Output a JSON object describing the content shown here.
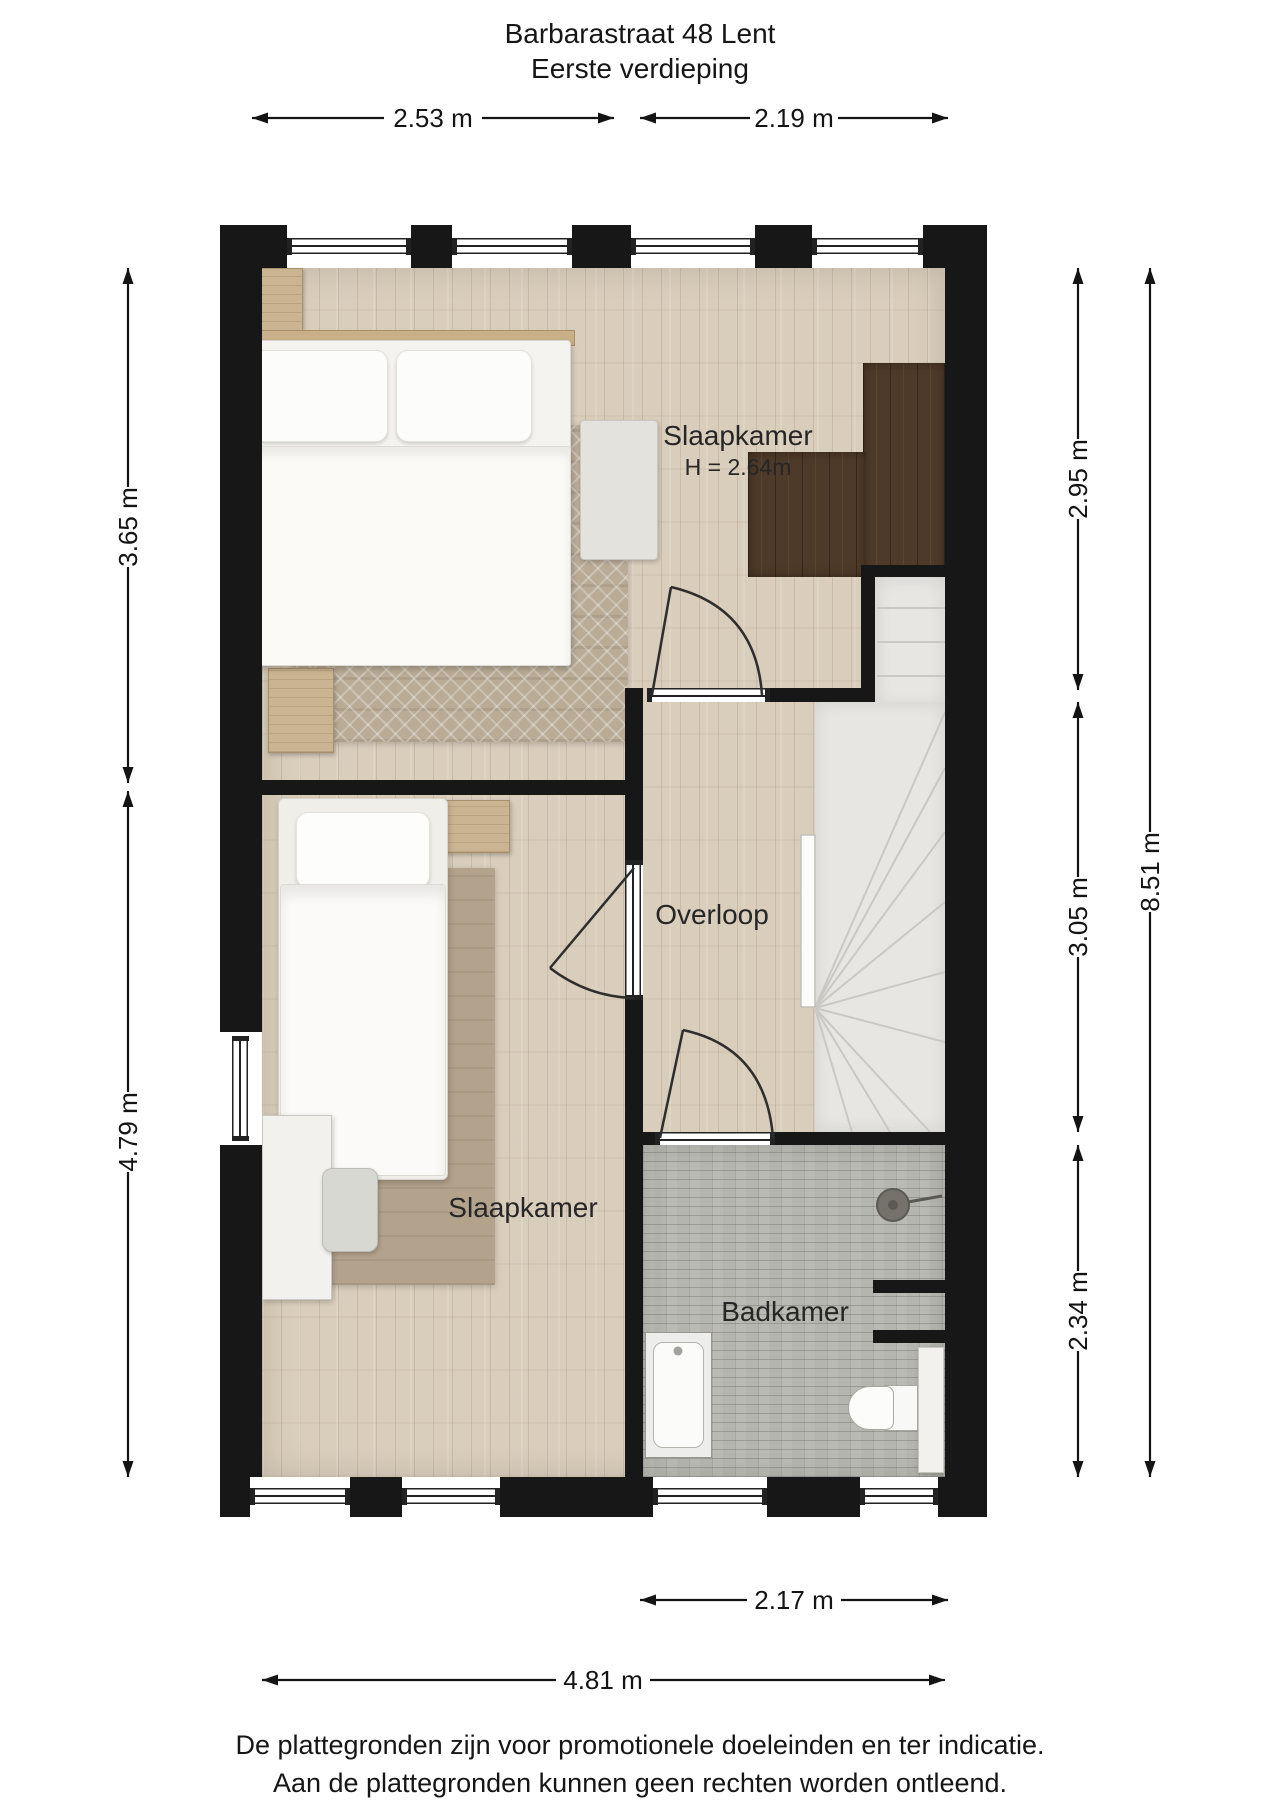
{
  "title": {
    "line1": "Barbarastraat 48 Lent",
    "line2": "Eerste verdieping"
  },
  "rooms": {
    "bedroom1": {
      "label": "Slaapkamer",
      "height": "H = 2.64m"
    },
    "landing": {
      "label": "Overloop"
    },
    "bedroom2": {
      "label": "Slaapkamer"
    },
    "bathroom": {
      "label": "Badkamer"
    }
  },
  "dimensions": {
    "top": [
      "2.53 m",
      "2.19 m"
    ],
    "left": [
      "3.65 m",
      "4.79 m"
    ],
    "right": [
      "2.95 m",
      "3.05 m",
      "2.34 m"
    ],
    "right_total": "8.51 m",
    "bottom_bathroom": "2.17 m",
    "bottom_total": "4.81 m"
  },
  "footer": {
    "line1": "De plattegronden zijn voor promotionele doeleinden en ter indicatie.",
    "line2": "Aan de plattegronden kunnen geen rechten worden ontleend."
  },
  "colors": {
    "wall": "#171717",
    "wood_floor": "#d9cdbb",
    "tile_floor": "#b5b5af",
    "stairs": "#e7e6e3",
    "dark_wardrobe": "#4e3a28",
    "text": "#1c1c1c"
  }
}
